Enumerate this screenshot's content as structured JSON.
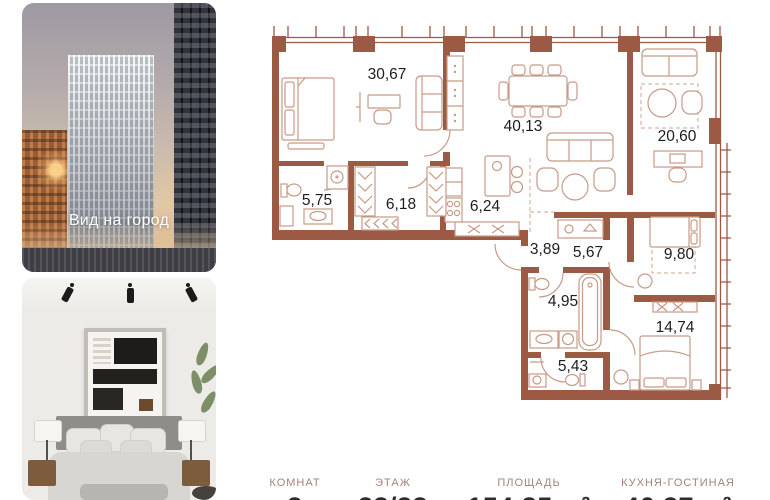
{
  "photos": {
    "city": {
      "caption": "Вид на город"
    }
  },
  "plan": {
    "rooms": [
      {
        "id": "bedroom-master",
        "area": "30,67"
      },
      {
        "id": "living-room",
        "area": "40,13"
      },
      {
        "id": "room-right",
        "area": "20,60"
      },
      {
        "id": "bathroom-1",
        "area": "5,75"
      },
      {
        "id": "hallway",
        "area": "6,18"
      },
      {
        "id": "kitchen",
        "area": "6,24"
      },
      {
        "id": "corridor",
        "area": "3,89"
      },
      {
        "id": "wardrobe",
        "area": "5,67"
      },
      {
        "id": "bedroom-2",
        "area": "9,80"
      },
      {
        "id": "bathroom-2",
        "area": "4,95"
      },
      {
        "id": "bedroom-3",
        "area": "14,74"
      },
      {
        "id": "bathroom-3",
        "area": "5,43"
      }
    ]
  },
  "stats": [
    {
      "label": "КОМНАТ",
      "value": "3"
    },
    {
      "label": "ЭТАЖ",
      "value": "23/33"
    },
    {
      "label": "ПЛОЩАДЬ",
      "value": "154,35 м²"
    },
    {
      "label": "КУХНЯ-ГОСТИНАЯ",
      "value": "46,37 м²"
    }
  ],
  "colors": {
    "wall": "#9c5a44",
    "furniture_line": "#c79a87",
    "room_label": "#1d1d1d",
    "stat_label": "#a28377",
    "stat_value": "#2d2d2d",
    "caption": "#ffffff"
  }
}
